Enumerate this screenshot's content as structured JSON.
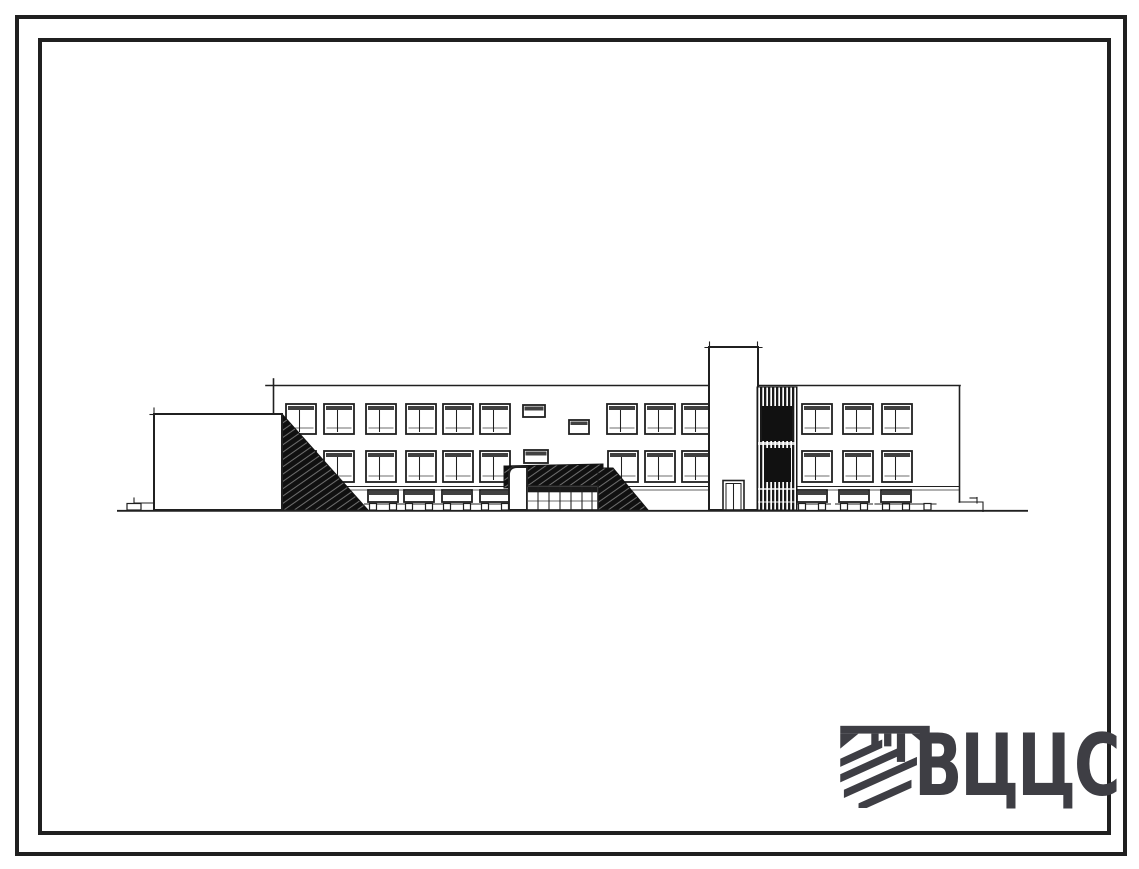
{
  "sheet": {
    "description_text": "",
    "logo": {
      "text": "ВЦЦС",
      "icon": "hatched-construction-emblem",
      "color": "#3e3e44"
    }
  },
  "colors": {
    "paper": "#ffffff",
    "ink": "#202020",
    "frame": "#151515",
    "hatch_fill": "#101010"
  },
  "drawing": {
    "subject": "building-front-elevation",
    "window_rows": [
      {
        "name": "third-floor-windows",
        "y": 404,
        "h": 30,
        "w": 30,
        "x": [
          286,
          324,
          366,
          406,
          443,
          480,
          607,
          645,
          682,
          802,
          843,
          882
        ]
      },
      {
        "name": "second-floor-windows",
        "y": 451,
        "h": 31,
        "w": 30,
        "x": [
          286,
          324,
          366,
          406,
          443,
          480,
          608,
          645,
          682,
          802,
          843,
          882
        ]
      }
    ],
    "vent_windows": [
      [
        523,
        405,
        22,
        12
      ],
      [
        524,
        450,
        24,
        13
      ]
    ],
    "small_window": [
      569,
      420,
      20,
      14
    ],
    "ground_windows": {
      "y": 490,
      "h": 12,
      "w": 30,
      "x": [
        368,
        404,
        442,
        480,
        797,
        839,
        881
      ]
    }
  }
}
